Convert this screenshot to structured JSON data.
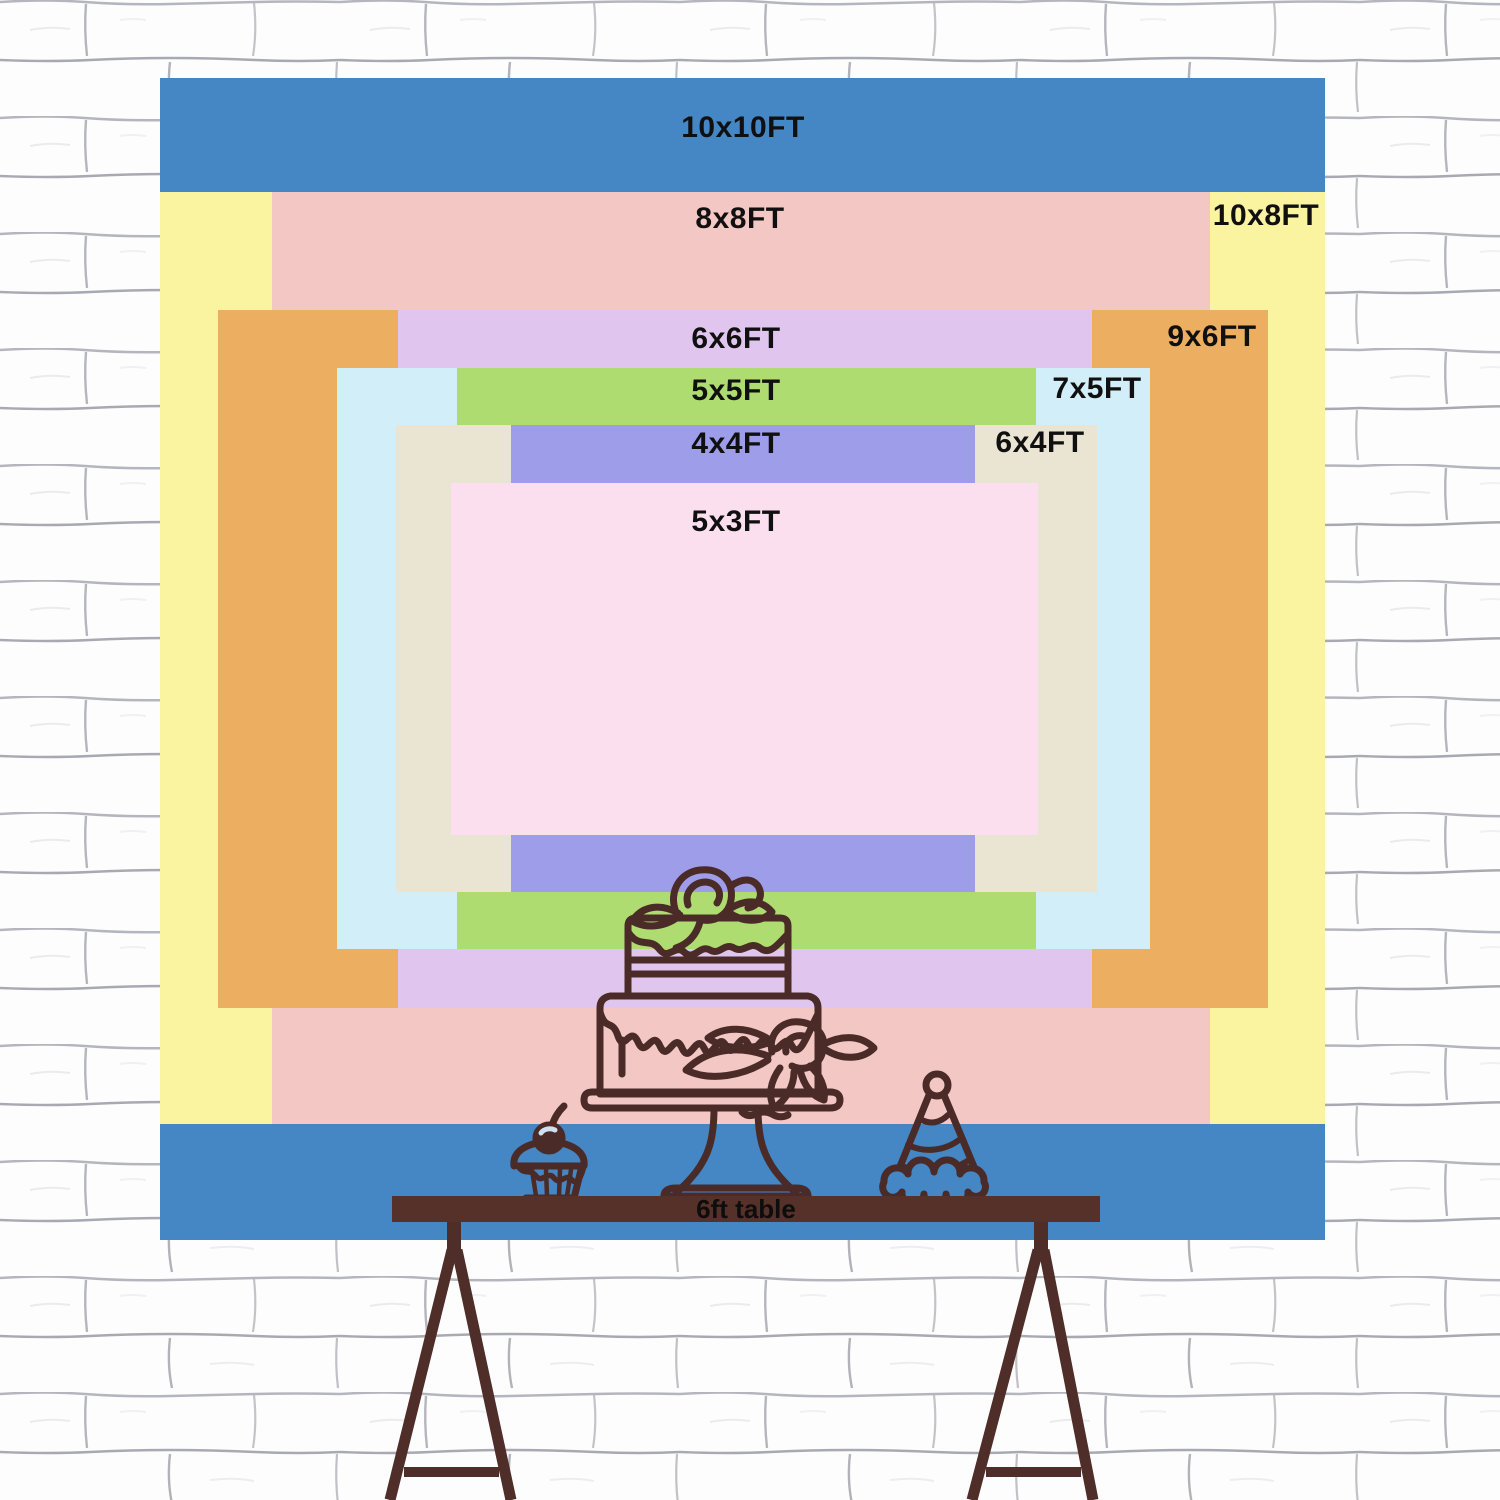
{
  "page": {
    "type": "backdrop-size-comparison-chart",
    "background": "white painted brick wall"
  },
  "wall": {
    "brick_color": "#fdfdfd",
    "mortar_color": "#a3a4ac"
  },
  "backdrop": {
    "rects": [
      {
        "label": "10x10FT",
        "color": "#4586c4",
        "label_placement": "top-center"
      },
      {
        "label": "10x8FT",
        "color": "#faf3a0",
        "label_placement": "top-right"
      },
      {
        "label": "8x8FT",
        "color": "#f3c7c4",
        "label_placement": "top-center"
      },
      {
        "label": "9x6FT",
        "color": "#ecae60",
        "label_placement": "top-right"
      },
      {
        "label": "6x6FT",
        "color": "#e0c6ee",
        "label_placement": "top-center"
      },
      {
        "label": "7x5FT",
        "color": "#d2eef8",
        "label_placement": "top-right"
      },
      {
        "label": "5x5FT",
        "color": "#aedc70",
        "label_placement": "top-center"
      },
      {
        "label": "6x4FT",
        "color": "#eae4d2",
        "label_placement": "top-right"
      },
      {
        "label": "4x4FT",
        "color": "#9d9de9",
        "label_placement": "top-center"
      },
      {
        "label": "5x3FT",
        "color": "#fcdfee",
        "label_placement": "top-center"
      }
    ],
    "text_color": "#101010"
  },
  "table": {
    "label": "6ft table",
    "top_color": "#553129",
    "leg_color": "#4f2d28"
  },
  "illustrations": {
    "line_color": "#4a2b27",
    "items": [
      "birthday-cake",
      "cupcake",
      "party-hat"
    ]
  }
}
